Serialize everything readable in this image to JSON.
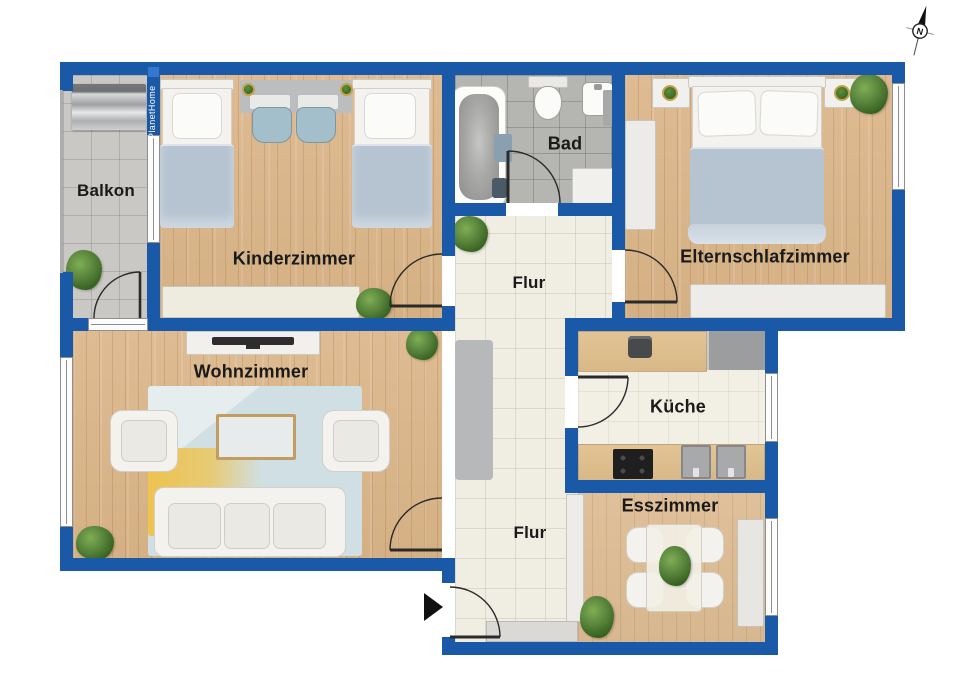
{
  "branding": {
    "watermark": "PlanetHome"
  },
  "compass": {
    "north_label": "N"
  },
  "rooms": {
    "balkon": {
      "label": "Balkon"
    },
    "kinderzimmer": {
      "label": "Kinderzimmer"
    },
    "bad": {
      "label": "Bad"
    },
    "elternschlafzimmer": {
      "label": "Elternschlafzimmer"
    },
    "flur_oben": {
      "label": "Flur"
    },
    "wohnzimmer": {
      "label": "Wohnzimmer"
    },
    "kueche": {
      "label": "Küche"
    },
    "esszimmer": {
      "label": "Esszimmer"
    },
    "flur_unten": {
      "label": "Flur"
    }
  },
  "colors": {
    "wall_blue": "#1a58a8",
    "wood_floor": "#d9b68c",
    "balcony_tile": "#c9c8c4",
    "bath_tile": "#b5b5b1",
    "hall_tile": "#f0ede2",
    "rug_blue": "#d0dfe3",
    "rug_yellow": "#eec34f",
    "blanket_blue": "#b6c4d1",
    "label_text": "#1a1a1a",
    "watermark_text": "#ffffff"
  }
}
